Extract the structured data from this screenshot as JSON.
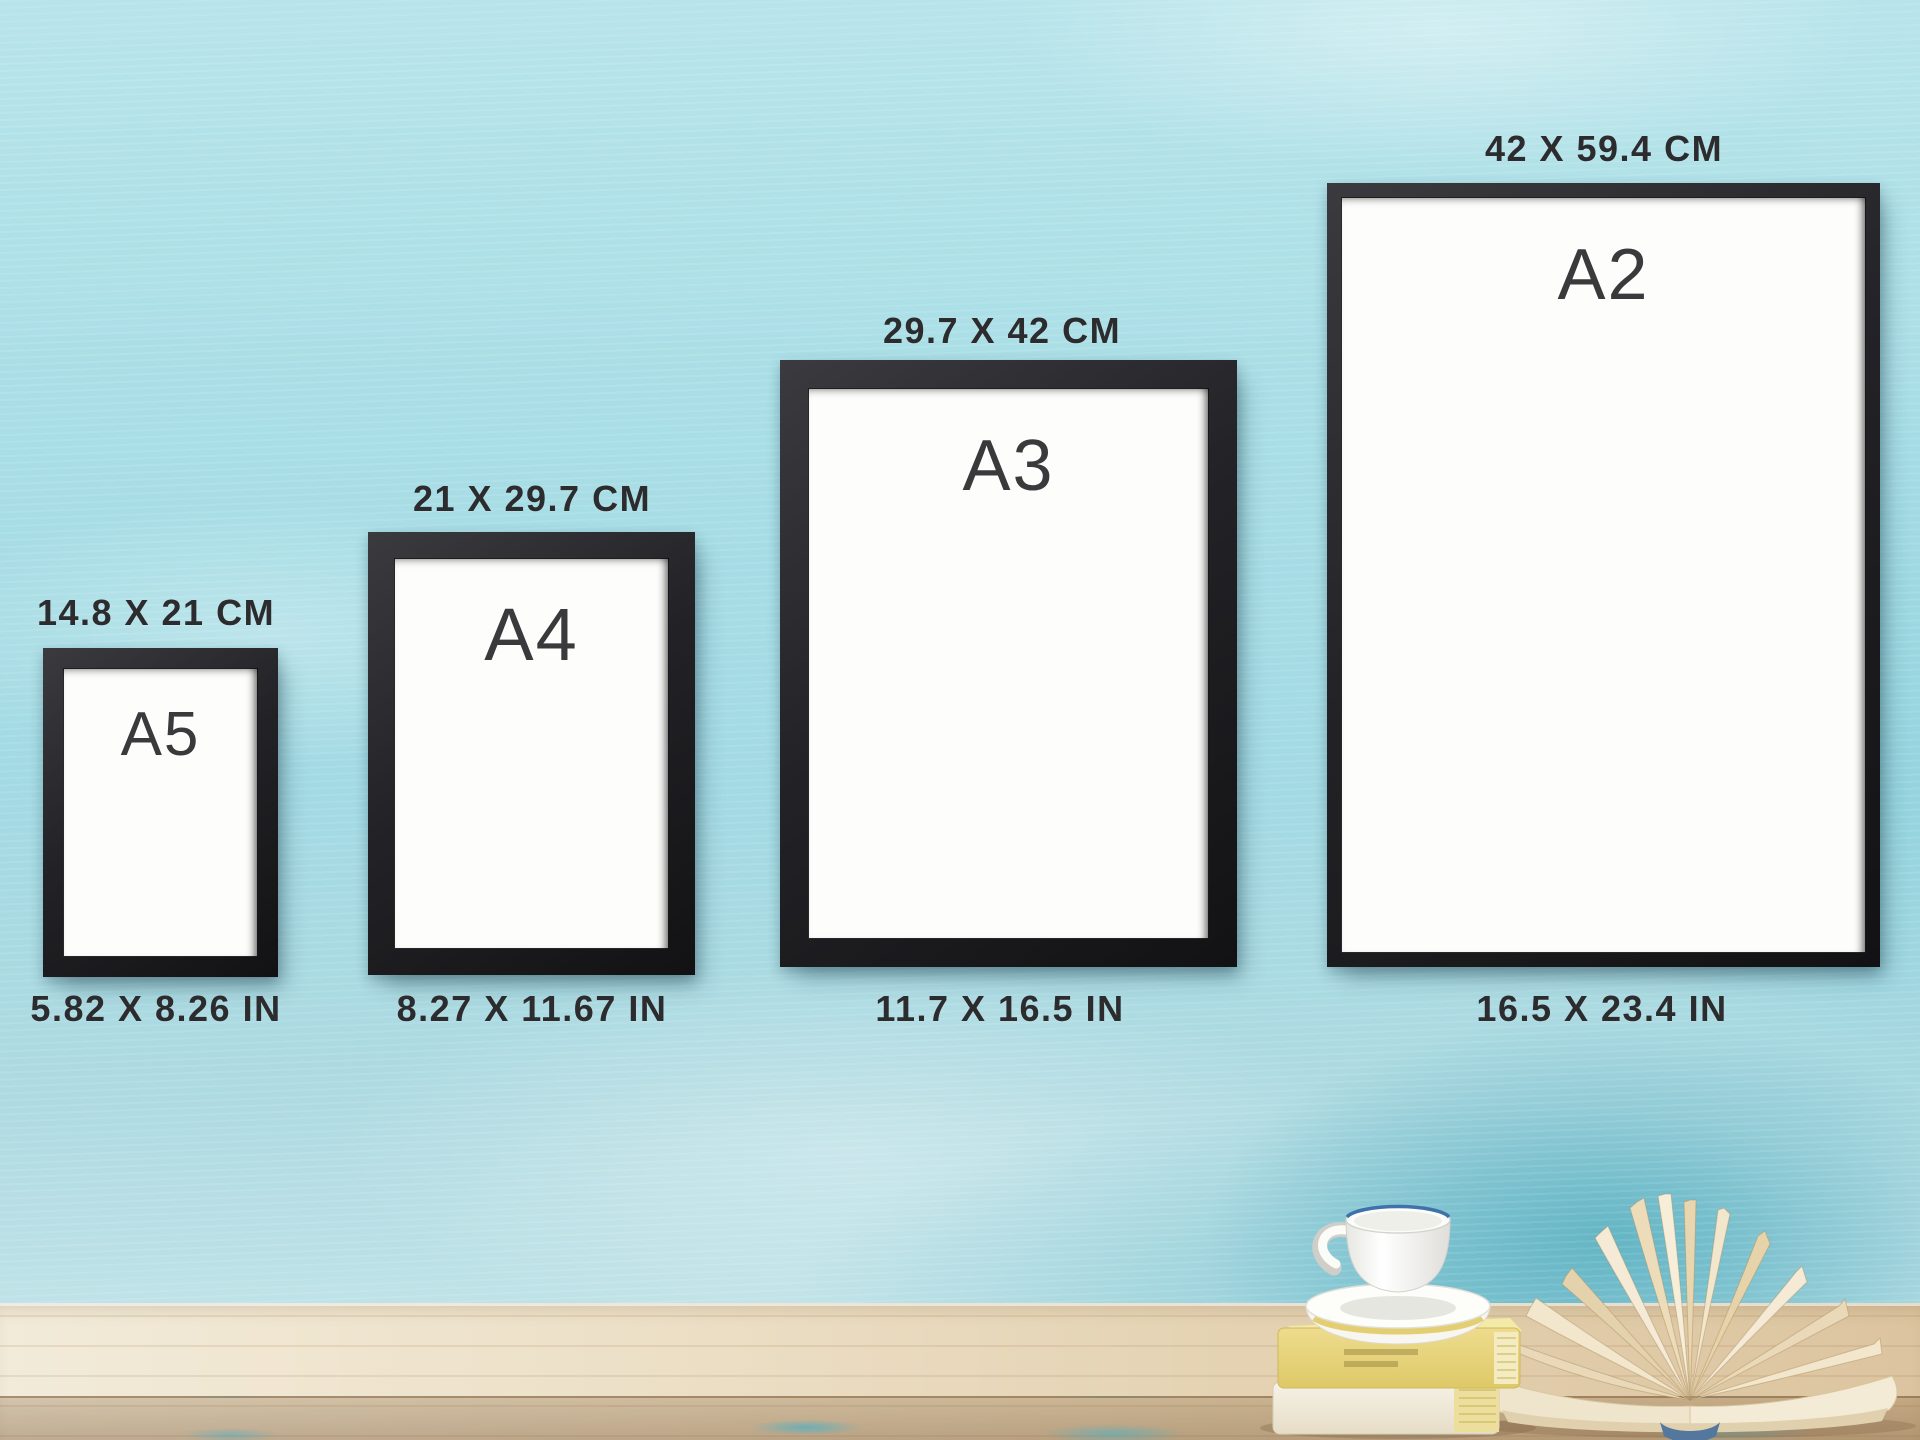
{
  "frames": [
    {
      "name": "A5",
      "metric": "14.8 X 21 CM",
      "imperial": "5.82 X 8.26 IN"
    },
    {
      "name": "A4",
      "metric": "21 X 29.7 CM",
      "imperial": "8.27 X 11.67 IN"
    },
    {
      "name": "A3",
      "metric": "29.7 X 42 CM",
      "imperial": "11.7 X 16.5 IN"
    },
    {
      "name": "A2",
      "metric": "42 X 59.4 CM",
      "imperial": "16.5 X 23.4 IN"
    }
  ],
  "colors": {
    "wall": "#a6dce4",
    "wall_deep_teal": "#4fb0c2",
    "frame_black": "#1e1e21",
    "paper_white": "#fdfdfc",
    "label_text": "#2c2c2e",
    "table_light_wood": "#f1e9d6",
    "table_dark_wood": "#dcc49f",
    "book_yellow": "#e7d480",
    "book_cream": "#f3efe4",
    "open_book_page": "#f2e6cc",
    "book_spine_blue": "#54779e",
    "cup_rim_blue": "#3f72aa"
  },
  "icons": {
    "coffee_cup": "coffee-cup-icon",
    "book_stack": "book-stack-icon",
    "open_book": "open-book-icon"
  }
}
